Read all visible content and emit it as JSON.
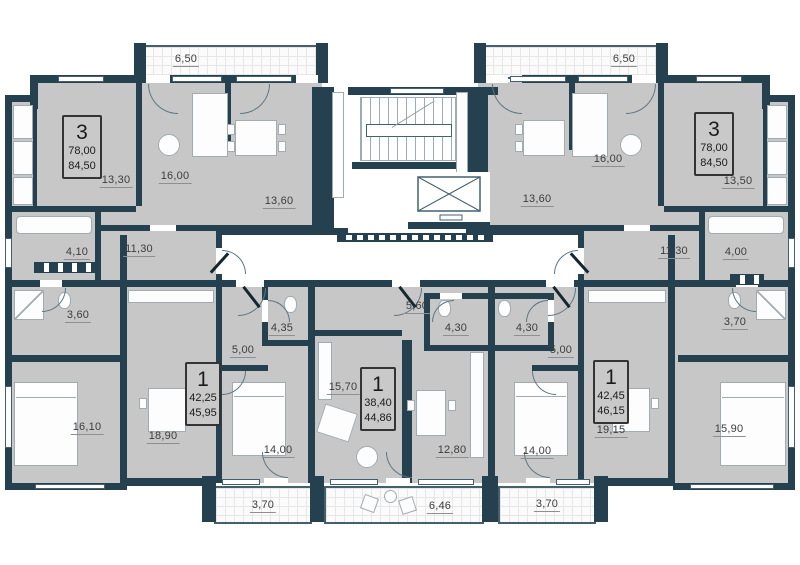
{
  "colors": {
    "wall": "#25404e",
    "floor": "#c7c7c7",
    "balcony_line": "#44606f",
    "label_text": "#3d3d3d"
  },
  "apartments": [
    {
      "key": "top-left-3-room",
      "rooms": "3",
      "living_area": "78,00",
      "total_area": "84,50"
    },
    {
      "key": "top-right-3-room",
      "rooms": "3",
      "living_area": "78,00",
      "total_area": "84,50"
    },
    {
      "key": "bottom-left-1-room",
      "rooms": "1",
      "living_area": "42,25",
      "total_area": "45,95"
    },
    {
      "key": "bottom-center-1-room",
      "rooms": "1",
      "living_area": "38,40",
      "total_area": "44,86"
    },
    {
      "key": "bottom-right-1-room",
      "rooms": "1",
      "living_area": "42,45",
      "total_area": "46,15"
    }
  ],
  "labels": {
    "balcony_top_left": "6,50",
    "balcony_top_right": "6,50",
    "apt3l_room_13_30": "13,30",
    "apt3l_room_16_00": "16,00",
    "apt3l_kitchen_13_60": "13,60",
    "apt3l_bath_4_10": "4,10",
    "apt3l_hall_11_30": "11,30",
    "apt3l_wc_3_60": "3,60",
    "apt3l_bedroom_16_10": "16,10",
    "apt3r_kitchen_13_60": "13,60",
    "apt3r_room_16_00": "16,00",
    "apt3r_room_13_50": "13,50",
    "apt3r_hall_11_30": "11,30",
    "apt3r_bath_4_00": "4,00",
    "apt3r_wc_3_70": "3,70",
    "apt3r_bedroom_15_90": "15,90",
    "apt1l_living_18_90": "18,90",
    "apt1l_hall_5_00": "5,00",
    "apt1l_bath_4_35": "4,35",
    "apt1l_bedroom_14_00": "14,00",
    "apt1c_living_15_70": "15,70",
    "apt1c_hall_5_60": "5,60",
    "apt1c_bath_4_30": "4,30",
    "apt1c_kitchen_12_80": "12,80",
    "apt1r_bath_4_30": "4,30",
    "apt1r_hall_5_00": "5,00",
    "apt1r_bedroom_14_00": "14,00",
    "apt1r_living_19_15": "19,15",
    "balcony_bottom_left": "3,70",
    "balcony_bottom_center": "6,46",
    "balcony_bottom_right": "3,70"
  }
}
